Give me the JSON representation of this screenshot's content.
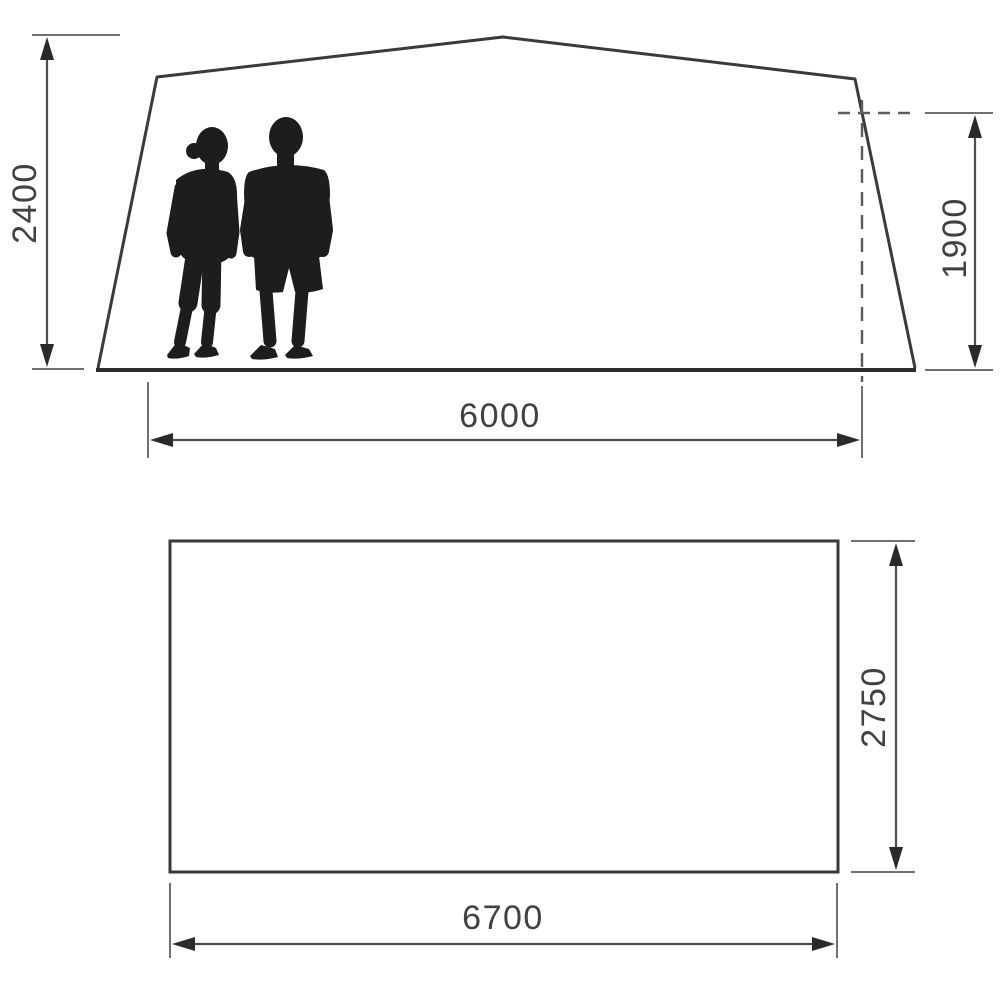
{
  "diagram": {
    "title": "tent-dimension-drawing",
    "front_view": {
      "height_left": "2400",
      "height_right": "1900",
      "width_bottom": "6000"
    },
    "floor_plan": {
      "depth_right": "2750",
      "width_bottom": "6700"
    },
    "colors": {
      "outline": "#3a3a3a",
      "ground": "#2d2d2d",
      "silhouette": "#1d1d1d",
      "dimension_line": "#4d4d4d",
      "extension_line": "#707070",
      "dashed_line": "#5c5c5c",
      "arrow": "#2a2a2a",
      "text": "#414042",
      "background": "#ffffff"
    }
  }
}
